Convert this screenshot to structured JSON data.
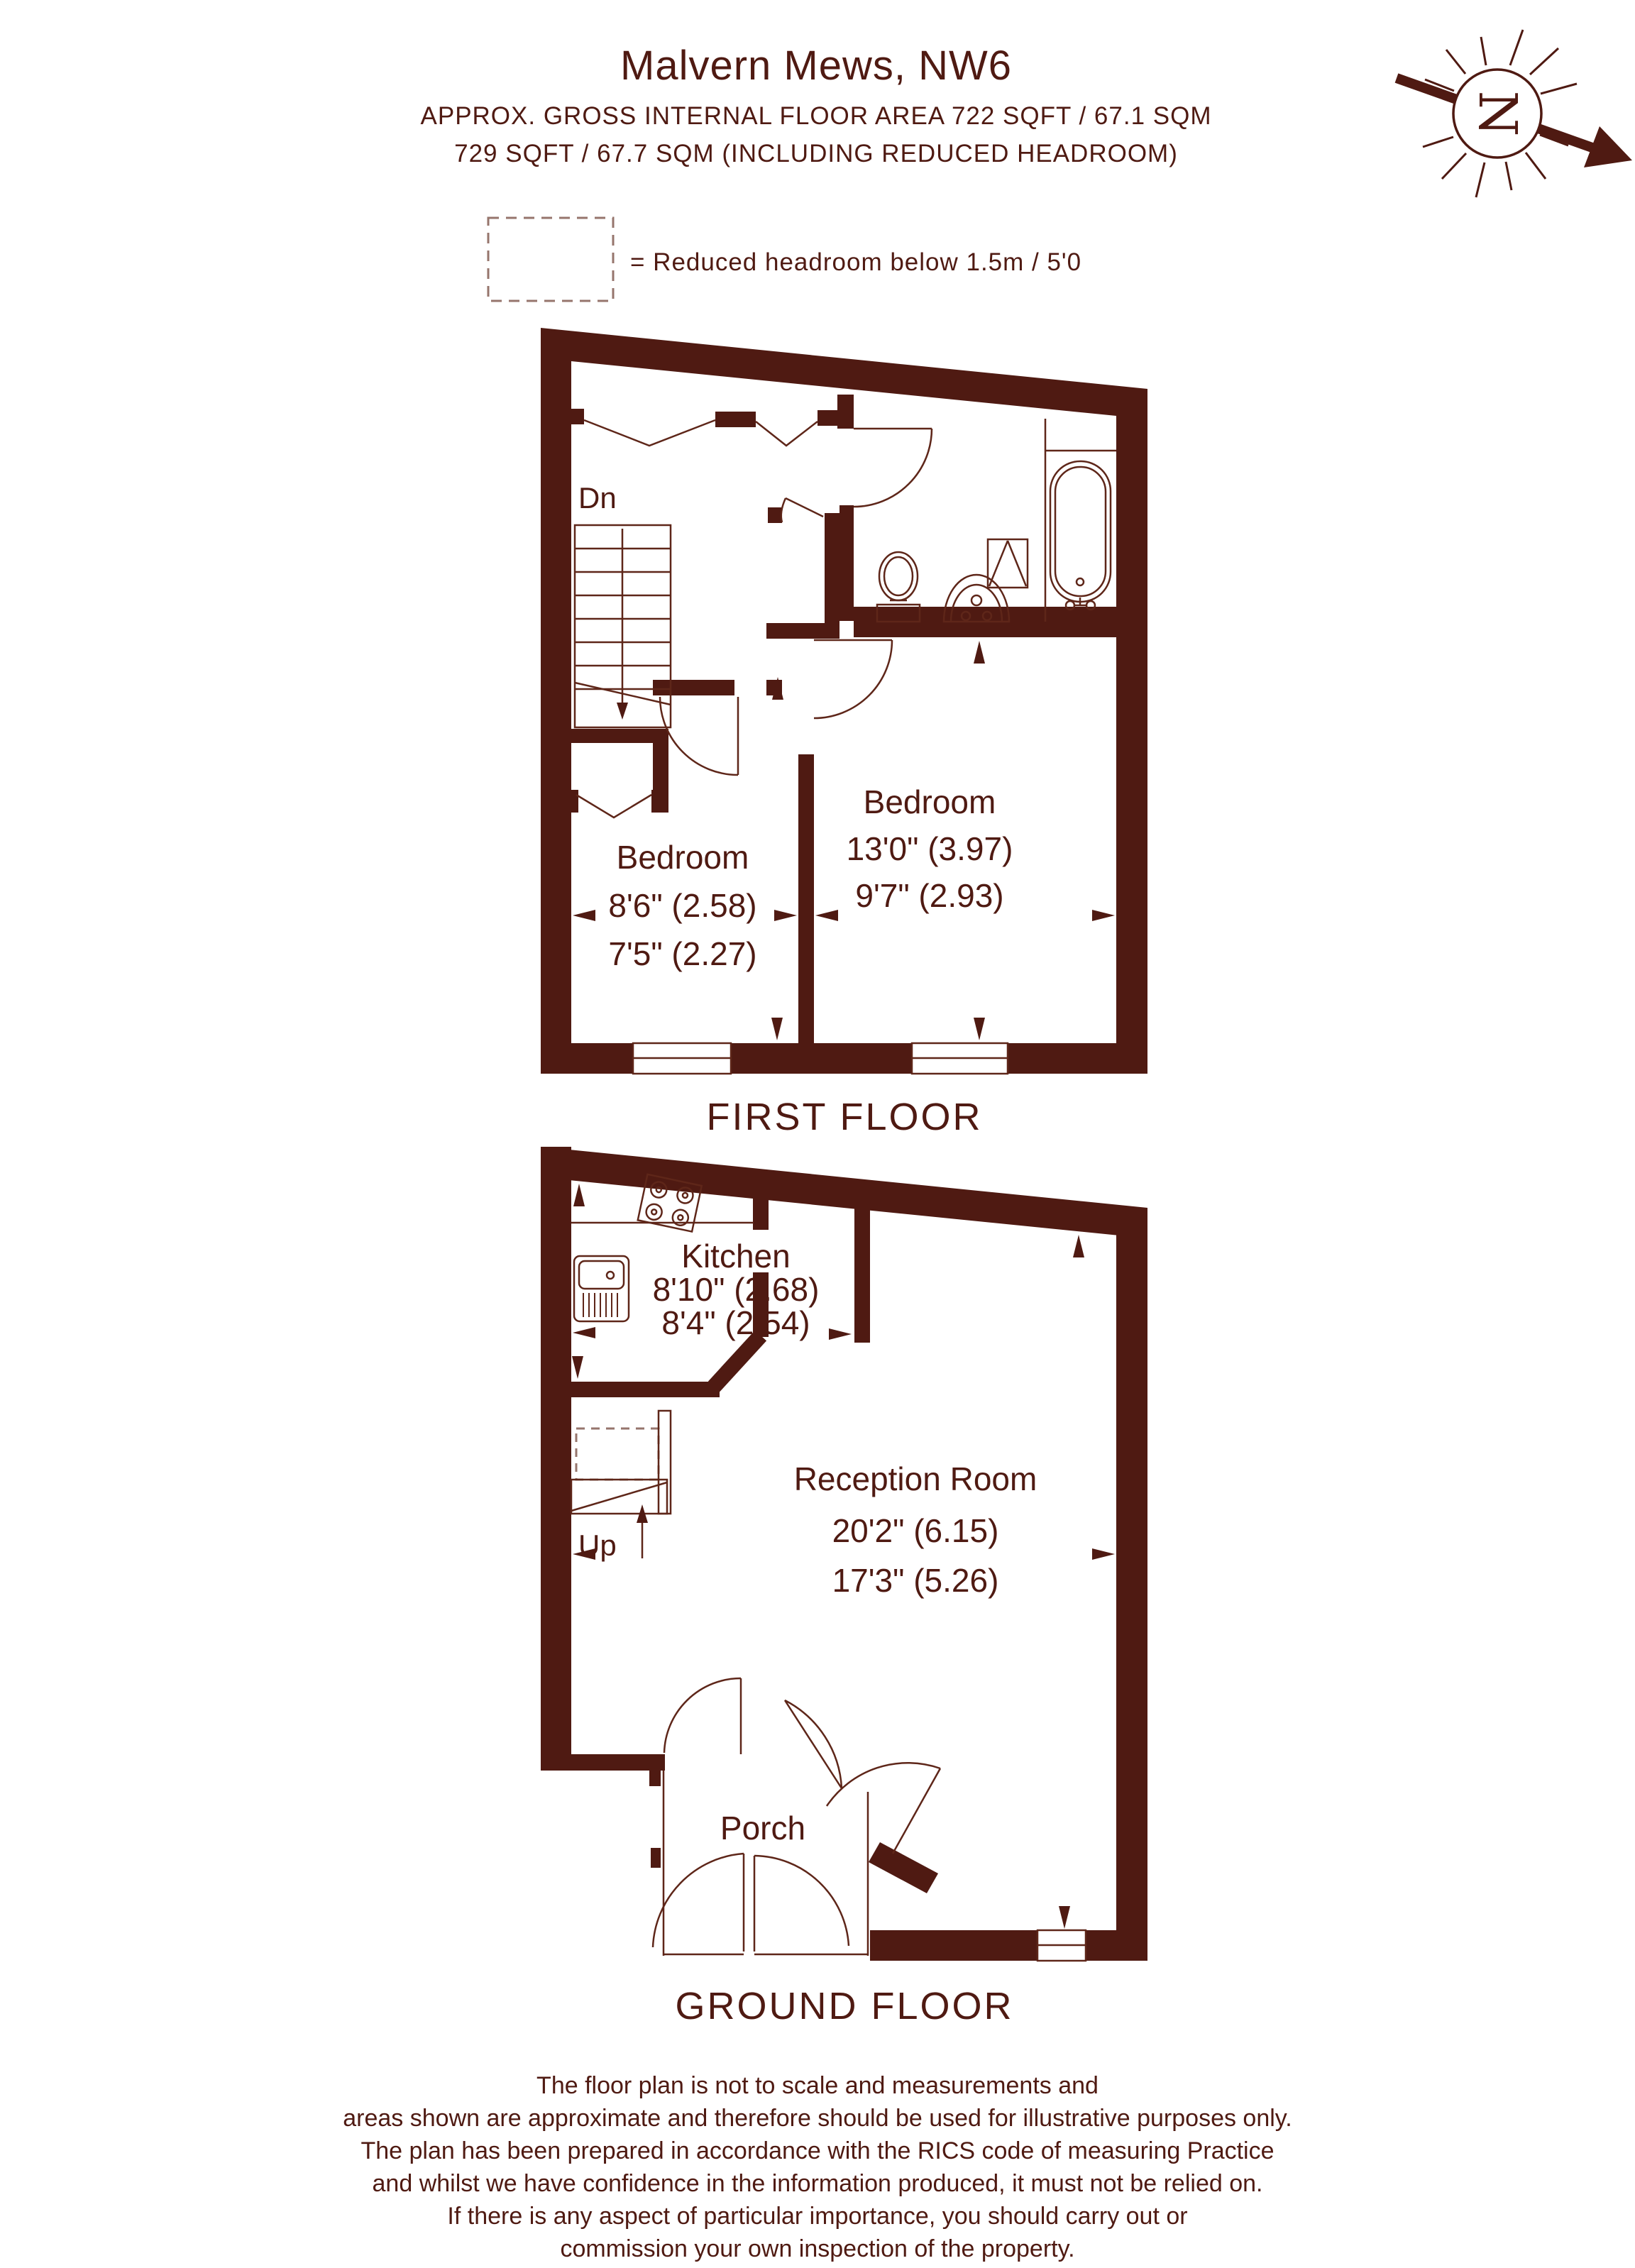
{
  "header": {
    "title": "Malvern Mews, NW6",
    "subtitle1": "APPROX. GROSS INTERNAL FLOOR AREA 722 SQFT / 67.1 SQM",
    "subtitle2": "729 SQFT / 67.7 SQM (INCLUDING REDUCED HEADROOM)"
  },
  "legend": {
    "text": "= Reduced headroom below 1.5m / 5'0"
  },
  "compass": {
    "letter": "N"
  },
  "floors": [
    {
      "name": "FIRST FLOOR",
      "stairs_label": "Dn",
      "rooms": [
        {
          "label": "Bedroom",
          "dim1": "13'0\" (3.97)",
          "dim2": "9'7\" (2.93)"
        },
        {
          "label": "Bedroom",
          "dim1": "8'6\" (2.58)",
          "dim2": "7'5\" (2.27)"
        }
      ]
    },
    {
      "name": "GROUND FLOOR",
      "stairs_label": "Up",
      "rooms": [
        {
          "label": "Kitchen",
          "dim1": "8'10\" (2.68)",
          "dim2": "8'4\" (2.54)"
        },
        {
          "label": "Reception Room",
          "dim1": "20'2\" (6.15)",
          "dim2": "17'3\" (5.26)"
        },
        {
          "label": "Porch"
        }
      ]
    }
  ],
  "disclaimer": {
    "lines": [
      "The floor plan is not to scale and measurements and",
      "areas shown are approximate and therefore should be used for illustrative purposes only.",
      "The plan has been prepared in accordance with the RICS code of measuring Practice",
      "and whilst we have confidence in the information produced, it must not be relied on.",
      "If there is any aspect of particular importance, you should carry out or",
      "commission your own inspection of the property."
    ]
  },
  "colors": {
    "wall": "#4f1a12",
    "line": "#5e2619",
    "muted": "#96756c"
  }
}
